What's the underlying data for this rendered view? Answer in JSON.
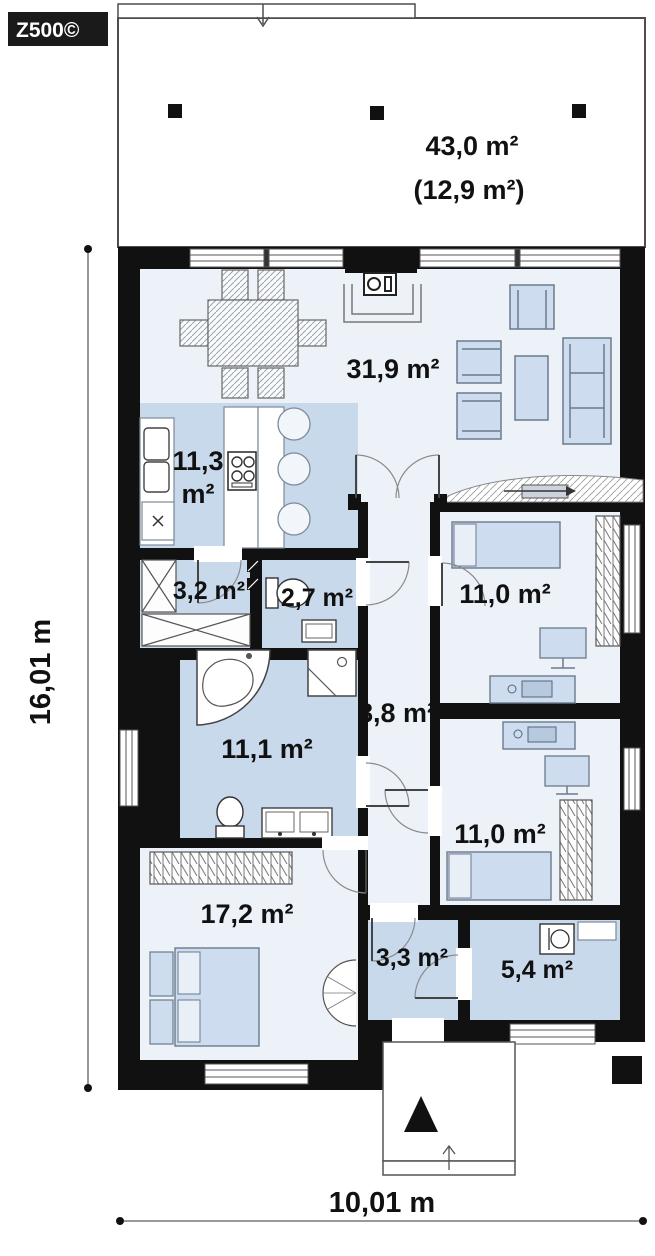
{
  "brand": {
    "logo": "Z500©"
  },
  "dimensions": {
    "height_label": "16,01 m",
    "width_label": "10,01 m"
  },
  "terrace": {
    "area": "43,0 m²",
    "covered_area": "(12,9 m²)"
  },
  "rooms": {
    "living": {
      "name": "living-dining-room",
      "area": "31,9 m²"
    },
    "kitchen": {
      "name": "kitchen",
      "area_line1": "11,3",
      "area_line2": "m²"
    },
    "pantry": {
      "name": "pantry-wardrobe",
      "area": "3,2 m²"
    },
    "wc": {
      "name": "wc",
      "area": "2,7 m²"
    },
    "hall": {
      "name": "hallway",
      "area": "8,8 m²"
    },
    "bedroom1": {
      "name": "bedroom-1",
      "area": "11,0 m²"
    },
    "bedroom2": {
      "name": "bedroom-2",
      "area": "11,0 m²"
    },
    "bathroom": {
      "name": "bathroom",
      "area": "11,1 m²"
    },
    "master": {
      "name": "master-bedroom",
      "area": "17,2 m²"
    },
    "vestibule": {
      "name": "entrance-vestibule",
      "area": "3,3 m²"
    },
    "utility": {
      "name": "utility-room",
      "area": "5,4 m²"
    }
  },
  "colors": {
    "wall": "#111111",
    "floor_light": "#edf2f9",
    "floor_blue": "#c9d9ec",
    "furniture": "#cddcee",
    "outline": "#6b7a8c"
  }
}
